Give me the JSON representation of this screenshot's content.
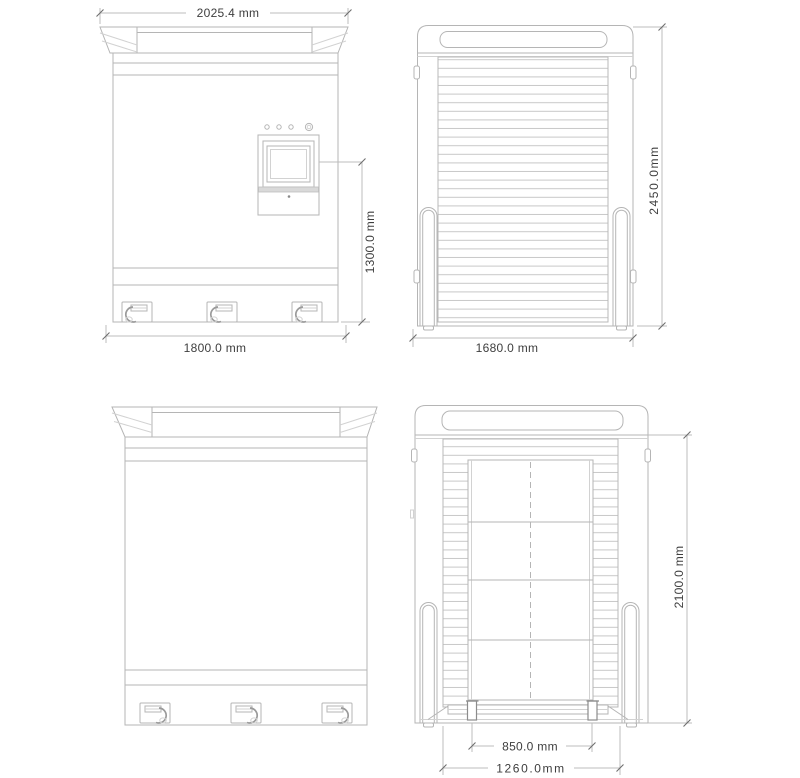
{
  "colors": {
    "line": "#b5b5b5",
    "dimension_line": "#bcbcbc",
    "text": "#3e3e3e",
    "panel_fill": "#d9d9d9",
    "background": "#ffffff"
  },
  "views": {
    "front": {
      "dims": {
        "top_width": "2025.4 mm",
        "screen_height": "1300.0 mm",
        "base_width": "1800.0 mm"
      }
    },
    "side": {
      "dims": {
        "height": "2450.0mm",
        "base_depth": "1680.0 mm"
      }
    },
    "rear": {
      "dims": {
        "height": "2100.0 mm",
        "ramp_width": "850.0 mm",
        "base_width": "1260.0mm"
      }
    }
  }
}
